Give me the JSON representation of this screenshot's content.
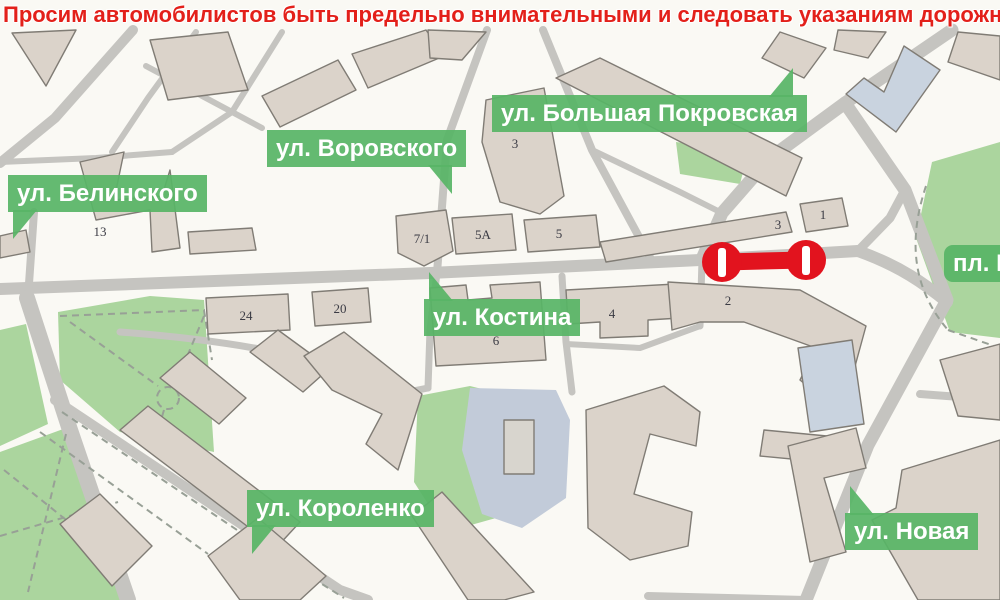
{
  "header": {
    "text": "Просим автомобилистов быть предельно внимательными и следовать указаниям дорожных "
  },
  "map": {
    "street_labels": [
      {
        "id": "belinskogo",
        "text": "ул. Белинского"
      },
      {
        "id": "vorovskogo",
        "text": "ул. Воровского"
      },
      {
        "id": "pokrovskaya",
        "text": "ул. Большая Покровская"
      },
      {
        "id": "kostina",
        "text": "ул. Костина"
      },
      {
        "id": "korolenko",
        "text": "ул. Короленко"
      },
      {
        "id": "novaya",
        "text": "ул. Новая"
      },
      {
        "id": "pl_m",
        "text": "пл. М"
      }
    ],
    "building_numbers": [
      {
        "value": "13"
      },
      {
        "value": "3"
      },
      {
        "value": "7/1"
      },
      {
        "value": "5А"
      },
      {
        "value": "5"
      },
      {
        "value": "3"
      },
      {
        "value": "1"
      },
      {
        "value": "24"
      },
      {
        "value": "20"
      },
      {
        "value": "6"
      },
      {
        "value": "4"
      },
      {
        "value": "2"
      }
    ],
    "closure": {
      "description": "road closed segment"
    },
    "colors": {
      "header_red": "#e3201a",
      "closure_red": "#e2131e",
      "label_green": "#58b566",
      "park_green": "#abd59e",
      "road_gray": "#c5c4c0",
      "building_tan": "#dbd3ca",
      "building_blue": "#c9d3df",
      "pond_blue": "#c2cbd9"
    }
  }
}
